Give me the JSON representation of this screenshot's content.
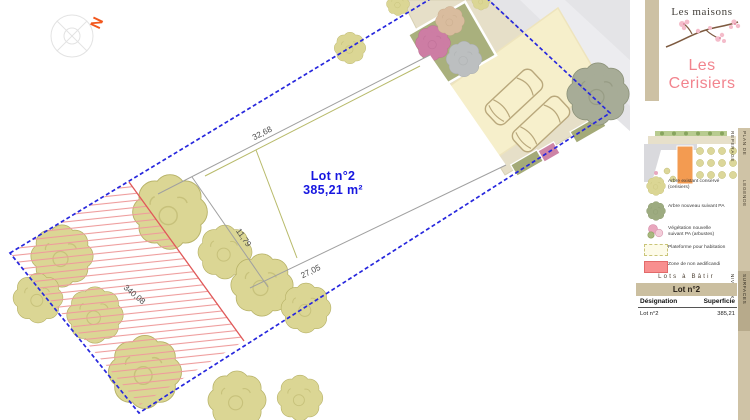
{
  "plan": {
    "north_label": "N",
    "lot": {
      "name": "Lot n°2",
      "area": "385,21 m²"
    },
    "dimensions": {
      "top": "32,68",
      "left": "11,79",
      "bottom": "27,05",
      "long": "340,08"
    }
  },
  "sidebar": {
    "brand_top": "Les maisons",
    "brand_name": "Les Cerisiers",
    "tabs": [
      "PLAN DE REPERAGE",
      "LEGENDE",
      "SURFACES NIVEAUX"
    ],
    "legend_items": [
      "Arbre existant conservé (cerisiers)",
      "Arbre nouveau suivant PA",
      "Végétation nouvelle suivant PA (arbustes)",
      "Plateforme pour habitation",
      "Zone de non aedificandi"
    ],
    "section_title": "Lots à Bâtir",
    "lot_banner": "Lot n°2",
    "table": {
      "headers": [
        "Désignation",
        "Superficie"
      ],
      "rows": [
        [
          "Lot n°2",
          "385,21"
        ]
      ]
    }
  },
  "colors": {
    "boundary_blue": "#2727dd",
    "lot_text_blue": "#1717e0",
    "hatch_red": "#ee9c9c",
    "tree_green": "#dbd694",
    "garden_green": "#a9b07d",
    "paving_beige": "#e6dfc8",
    "parking_cream": "#f6efcb",
    "road_gray": "#e4e4e7",
    "brand_pink": "#f2848e",
    "panel_tan": "#cfc3a6",
    "highlight_orange": "#f39b51",
    "north_orange": "#f2571d"
  }
}
